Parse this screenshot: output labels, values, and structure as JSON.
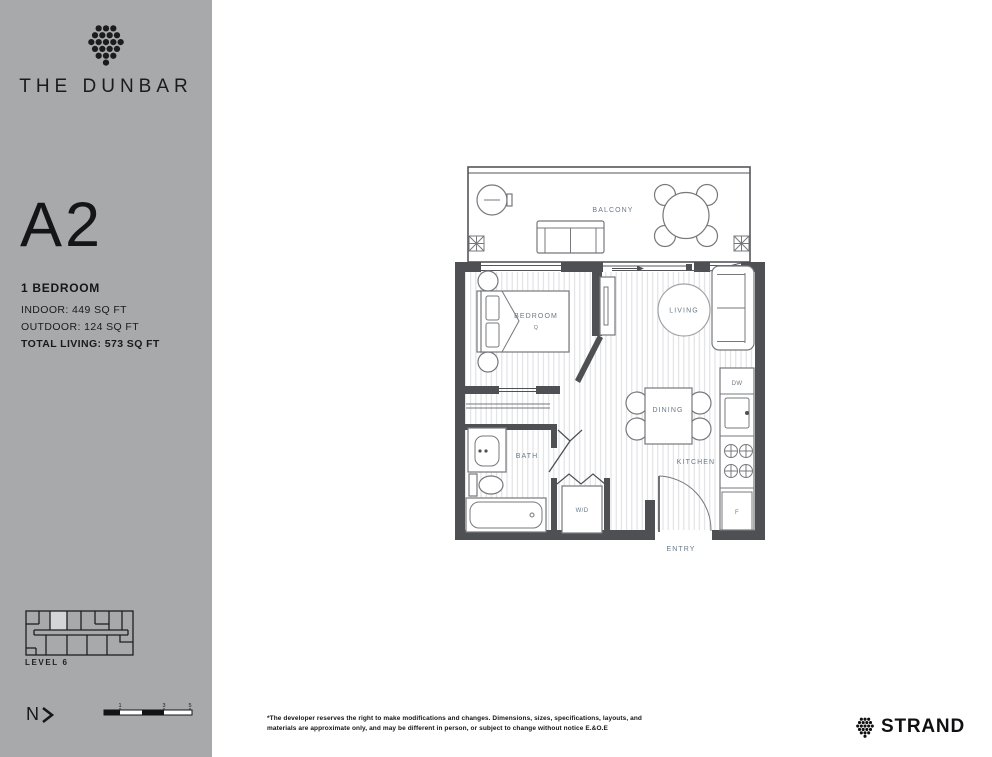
{
  "sidebar": {
    "brand": "THE DUNBAR",
    "plan_name": "A2",
    "plan_type": "1 BEDROOM",
    "stats": [
      "INDOOR: 449 SQ FT",
      "OUTDOOR: 124 SQ FT",
      "TOTAL LIVING: 573 SQ FT"
    ],
    "level_label": "LEVEL 6",
    "north_label": "N",
    "scale_ticks": [
      "1",
      "3",
      "5"
    ]
  },
  "floorplan": {
    "labels": {
      "balcony": "BALCONY",
      "bedroom": "BEDROOM",
      "bed_size": "Q",
      "living": "LIVING",
      "dining": "DINING",
      "kitchen": "KITCHEN",
      "bath": "BATH",
      "washer_dryer": "W/D",
      "entry": "ENTRY",
      "dishwasher": "DW",
      "fridge": "F"
    }
  },
  "footer": {
    "disclaimer": "*The developer reserves the right to make modifications and changes. Dimensions, sizes, specifications, layouts, and materials are approximate only, and may be different in person, or subject to change without notice E.&O.E",
    "brand": "STRAND"
  },
  "colors": {
    "sidebar_bg": "#a8a9ab",
    "wall": "#4f5053",
    "plan_label": "#69798a",
    "keyplan_highlight": "#d4d5d7"
  }
}
